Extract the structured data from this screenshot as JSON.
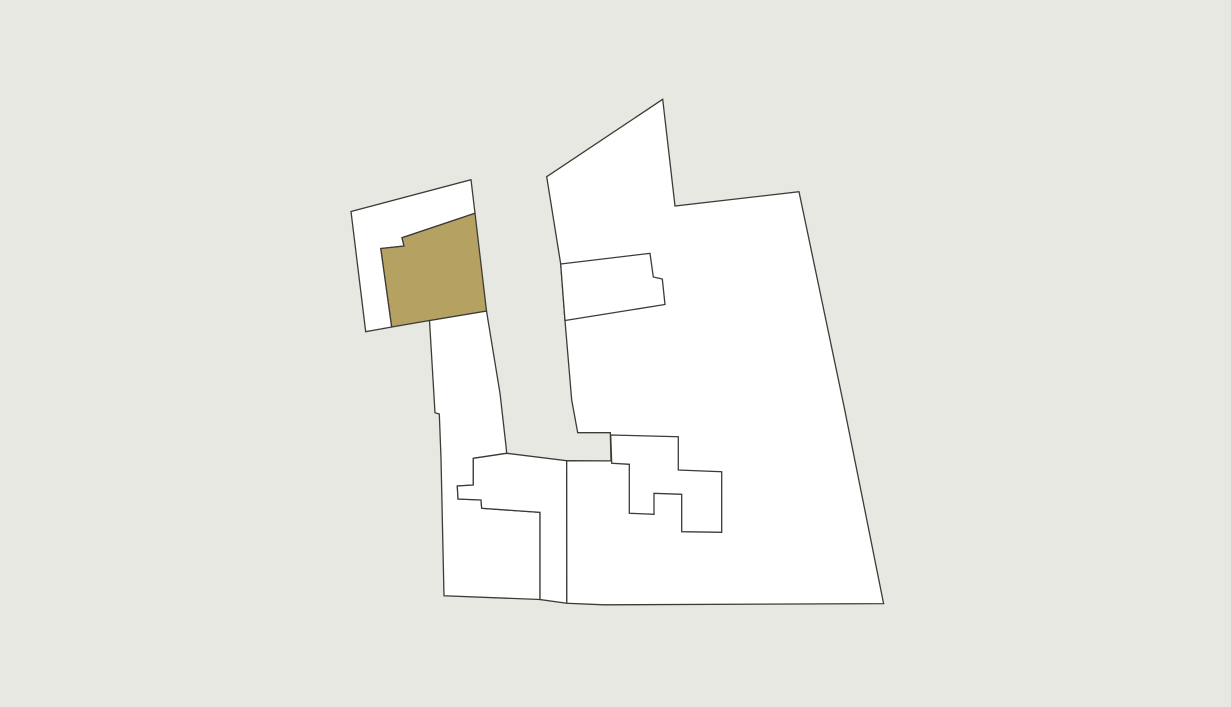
{
  "map": {
    "width": 1231,
    "height": 707,
    "background_color": "#E8E8E2",
    "style": {
      "parcel_fill": "#FFFFFF",
      "highlight_fill": "#B5A263",
      "stroke_color": "#3C3C37",
      "stroke_width": 1.3
    },
    "parcels": [
      {
        "name": "parcel-northwest-outer",
        "highlighted": false,
        "points": [
          [
            351,
            211.5
          ],
          [
            471,
            179.7
          ],
          [
            475,
            213.3
          ],
          [
            402,
            237.7
          ],
          [
            404,
            246
          ],
          [
            380.8,
            248.5
          ],
          [
            391.7,
            327
          ],
          [
            365.7,
            331.7
          ]
        ]
      },
      {
        "name": "parcel-corridor-southwest",
        "highlighted": false,
        "points": [
          [
            429.5,
            320.5
          ],
          [
            486.5,
            311
          ],
          [
            500,
            393.3
          ],
          [
            506,
            446
          ],
          [
            506.7,
            453.3
          ],
          [
            473.3,
            458.3
          ],
          [
            473.3,
            485
          ],
          [
            457.3,
            486
          ],
          [
            458,
            499
          ],
          [
            481,
            500
          ],
          [
            481.7,
            508.3
          ],
          [
            540,
            512.3
          ],
          [
            540,
            599.5
          ],
          [
            444,
            595.8
          ],
          [
            441,
            458
          ],
          [
            439.3,
            414
          ],
          [
            435,
            412.7
          ]
        ]
      },
      {
        "name": "parcel-south-left",
        "highlighted": false,
        "points": [
          [
            473.3,
            458.3
          ],
          [
            506.7,
            453.3
          ],
          [
            566.7,
            460.7
          ],
          [
            566.8,
            603.3
          ],
          [
            540,
            599.5
          ],
          [
            540,
            512.3
          ],
          [
            481.7,
            508.3
          ],
          [
            481,
            500
          ],
          [
            458,
            499
          ],
          [
            457.3,
            486
          ],
          [
            473.3,
            485
          ]
        ]
      },
      {
        "name": "parcel-east-large",
        "highlighted": false,
        "points": [
          [
            662.7,
            99.3
          ],
          [
            675,
            206
          ],
          [
            799,
            191.7
          ],
          [
            844.7,
            409.7
          ],
          [
            883.6,
            603.6
          ],
          [
            604,
            604.8
          ],
          [
            566.8,
            603.3
          ],
          [
            566.7,
            460.7
          ],
          [
            611,
            460.9
          ],
          [
            610.3,
            432.7
          ],
          [
            577.7,
            432.7
          ],
          [
            571.7,
            400
          ],
          [
            565,
            320.7
          ],
          [
            560.7,
            264
          ],
          [
            546.7,
            176.7
          ]
        ]
      },
      {
        "name": "parcel-inner-north",
        "highlighted": false,
        "points": [
          [
            560.7,
            264
          ],
          [
            650,
            253.3
          ],
          [
            653.3,
            277
          ],
          [
            662.3,
            279
          ],
          [
            665,
            304.5
          ],
          [
            565,
            320.5
          ]
        ]
      },
      {
        "name": "parcel-inner-south-stepped",
        "highlighted": false,
        "points": [
          [
            610.7,
            435
          ],
          [
            678.3,
            436.7
          ],
          [
            678.3,
            470
          ],
          [
            721.7,
            471.7
          ],
          [
            721.7,
            532.3
          ],
          [
            681.7,
            531.7
          ],
          [
            681.7,
            494.3
          ],
          [
            654,
            493.3
          ],
          [
            654,
            514.3
          ],
          [
            629.3,
            513.3
          ],
          [
            629.3,
            464.3
          ],
          [
            611.7,
            463.3
          ]
        ]
      },
      {
        "name": "parcel-highlighted",
        "highlighted": true,
        "points": [
          [
            402,
            237.7
          ],
          [
            475,
            213.3
          ],
          [
            486.5,
            311
          ],
          [
            429.5,
            320.5
          ],
          [
            391.7,
            327
          ],
          [
            380.8,
            248.5
          ],
          [
            404,
            246
          ]
        ]
      }
    ]
  }
}
